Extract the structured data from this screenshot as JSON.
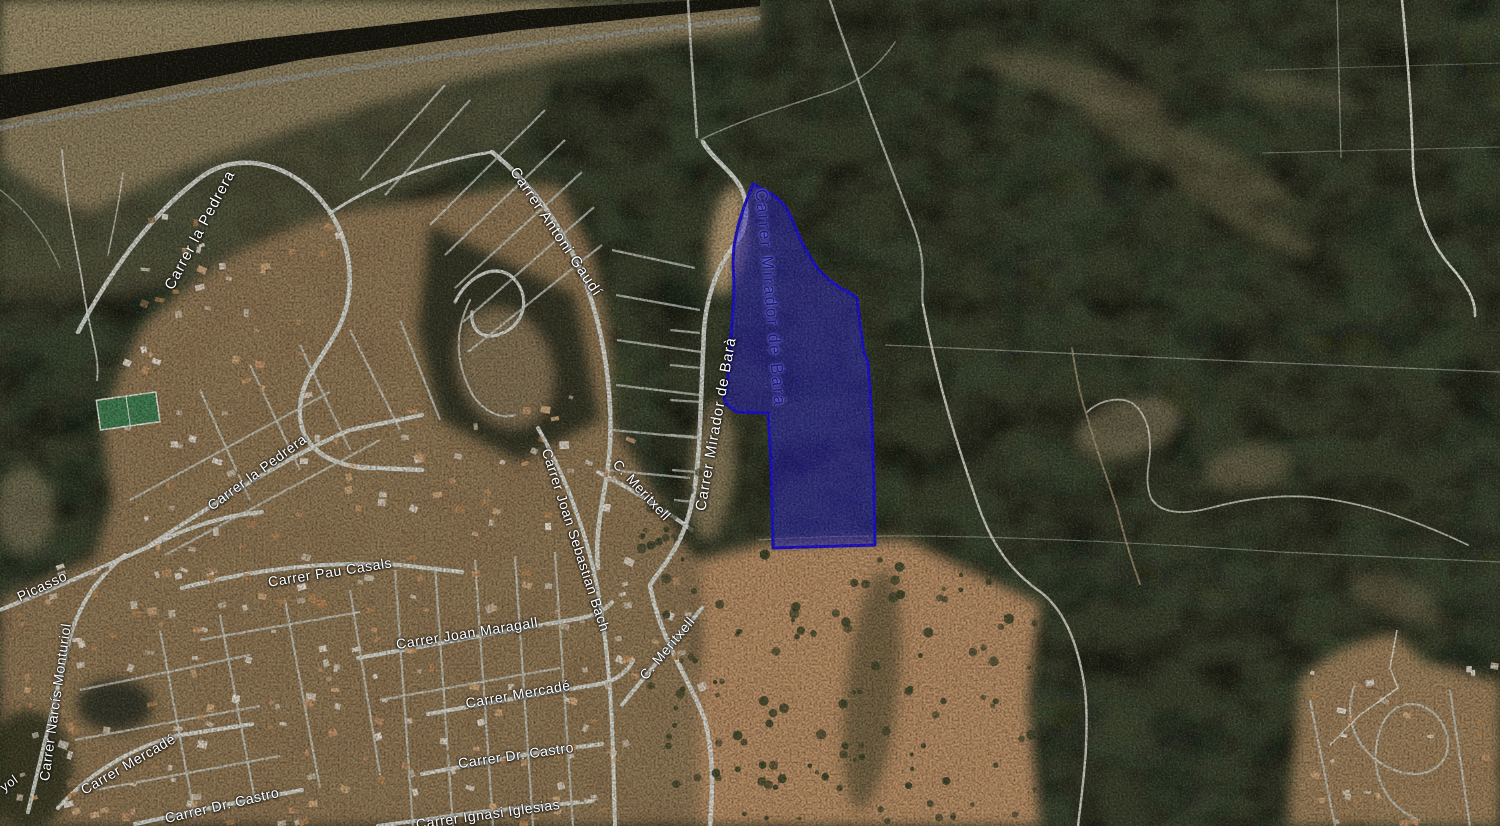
{
  "map": {
    "view": "satellite",
    "description": "Aerial satellite map of a hillside residential area (Roda de Berà style urbanization) with a highlighted land parcel",
    "highlight_color": "#2d26d9",
    "parcel_highlight": {
      "fill": "#2d26d9",
      "fill_opacity": 0.5,
      "stroke": "#1b10d0",
      "stroke_width": 3,
      "points": "753,184 764,190 776,197 784,205 790,215 796,229 802,243 809,255 817,268 827,278 839,287 850,293 857,298 859,315 862,338 864,353 868,361 870,388 872,424 873,458 874,492 875,545 773,548 772,502 771,462 769,428 768,413 737,412 727,405 724,399 727,385 729,360 731,336 733,310 734,286 733,263 734,246 738,226 744,207 749,194"
    },
    "street_labels": [
      {
        "text": "Carrer la Pedrera",
        "x": 200,
        "y": 230,
        "rotate": -62,
        "variant": "lg"
      },
      {
        "text": "Carrer Antoni Gaudí",
        "x": 556,
        "y": 232,
        "rotate": 56,
        "variant": "lg"
      },
      {
        "text": "Carrer Mirador de Barà",
        "x": 716,
        "y": 424,
        "rotate": -80,
        "variant": "lg"
      },
      {
        "text": "Carrer Mirador de Barà",
        "x": 770,
        "y": 298,
        "rotate": 85,
        "variant": "parcel"
      },
      {
        "text": "Carrer la Pedrera",
        "x": 257,
        "y": 472,
        "rotate": -36,
        "variant": ""
      },
      {
        "text": "Carrer Pau Casals",
        "x": 330,
        "y": 572,
        "rotate": -9,
        "variant": ""
      },
      {
        "text": "Carrer Joan Maragall",
        "x": 467,
        "y": 633,
        "rotate": -9,
        "variant": ""
      },
      {
        "text": "Carrer Mercadé",
        "x": 518,
        "y": 694,
        "rotate": -10,
        "variant": ""
      },
      {
        "text": "Carrer Mercadé",
        "x": 128,
        "y": 764,
        "rotate": -30,
        "variant": ""
      },
      {
        "text": "Carrer Dr. Castro",
        "x": 516,
        "y": 755,
        "rotate": -8,
        "variant": ""
      },
      {
        "text": "Carrer Dr. Castro",
        "x": 222,
        "y": 805,
        "rotate": -13,
        "variant": ""
      },
      {
        "text": "Carrer Ignasi Iglesias",
        "x": 488,
        "y": 814,
        "rotate": -8,
        "variant": ""
      },
      {
        "text": "C. Meritxell",
        "x": 642,
        "y": 490,
        "rotate": 47,
        "variant": ""
      },
      {
        "text": "C. Meritxell",
        "x": 667,
        "y": 648,
        "rotate": -50,
        "variant": ""
      },
      {
        "text": "Carrer Joan Sebastian Bach",
        "x": 576,
        "y": 540,
        "rotate": 72,
        "variant": ""
      },
      {
        "text": "Picasso",
        "x": 42,
        "y": 586,
        "rotate": -25,
        "variant": ""
      },
      {
        "text": "Carrer Narcís Monturiol",
        "x": 55,
        "y": 702,
        "rotate": -82,
        "variant": ""
      },
      {
        "text": "yol",
        "x": 9,
        "y": 783,
        "rotate": -35,
        "variant": "frag"
      }
    ]
  }
}
